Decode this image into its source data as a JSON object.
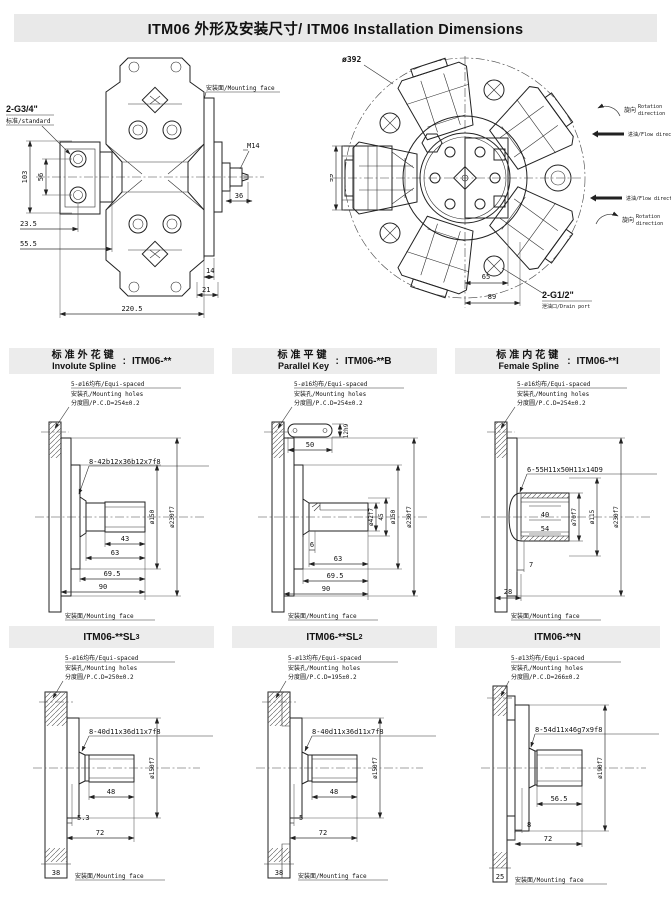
{
  "title": "ITM06 外形及安装尺寸/ ITM06 Installation Dimensions",
  "sep": ":",
  "colors": {
    "line": "#222222",
    "band": "#ececec",
    "paper": "#ffffff"
  },
  "side_view": {
    "ports_label": "2-G3/4\"",
    "ports_sub": "标准/standard",
    "mounting_face": "安装面/Mounting face",
    "shaft_thread": "M14",
    "d36": "36",
    "d103": "103",
    "d56": "56",
    "d23_5": "23.5",
    "d55_5": "55.5",
    "d14": "14",
    "d21": "21",
    "d220_5": "220.5"
  },
  "front_view": {
    "outer_dia": "ø392",
    "d99": "99",
    "d65": "65",
    "d89": "89",
    "drain_label": "2-G1/2\"",
    "drain_sub": "泄油口/Drain port",
    "rotation_cn": "旋向",
    "rotation_en1": "Rotation",
    "rotation_en2": "direction",
    "flow_label": "进油/Flow direction"
  },
  "middle_panels": [
    {
      "title_cn": "标准外花键",
      "title_en": "Involute Spline",
      "model": "ITM06-**",
      "note1": "5-ø16均布/Equi-spaced",
      "note2": "安装孔/Mounting holes",
      "note3": "分度圆/P.C.D=254±0.2",
      "spline": "8-42b12x36b12x7f8",
      "dia1": "ø150",
      "dia2": "ø230f7",
      "dim_a": "43",
      "dim_b": "63",
      "dim_c": "69.5",
      "dim_d": "90",
      "mounting_face": "安装面/Mounting face"
    },
    {
      "title_cn": "标准平键",
      "title_en": "Parallel Key",
      "model": "ITM06-**B",
      "note1": "5-ø16均布/Equi-spaced",
      "note2": "安装孔/Mounting holes",
      "note3": "分度圆/P.C.D=254±0.2",
      "key_len": "50",
      "key_w": "12h9",
      "shaft_dia": "ø42f7",
      "key_h": "45",
      "dia1": "ø150",
      "dia2": "ø230f7",
      "dim_a": "6",
      "dim_b": "63",
      "dim_c": "69.5",
      "dim_d": "90",
      "mounting_face": "安装面/Mounting face"
    },
    {
      "title_cn": "标准内花键",
      "title_en": "Female Spline",
      "model": "ITM06-**I",
      "note1": "5-ø16均布/Equi-spaced",
      "note2": "安装孔/Mounting holes",
      "note3": "分度圆/P.C.D=254±0.2",
      "spline": "6-55H11x50H11x14D9",
      "d40": "40",
      "d54": "54",
      "dia1": "ø70f7",
      "dia2": "ø115",
      "dia3": "ø230f7",
      "dim_a": "7",
      "dim_b": "28",
      "mounting_face": "安装面/Mounting face"
    }
  ],
  "bottom_panels": [
    {
      "model_base": "ITM06-**SL",
      "model_sub": "3",
      "note1": "5-ø16均布/Equi-spaced",
      "note2": "安装孔/Mounting holes",
      "note3": "分度圆/P.C.D=250±0.2",
      "spline": "8-40d11x36d11x7f8",
      "dia1": "ø150f7",
      "dim_a": "48",
      "dim_b": "5.3",
      "dim_c": "72",
      "dim_d": "38",
      "mounting_face": "安装面/Mounting face"
    },
    {
      "model_base": "ITM06-**SL",
      "model_sub": "2",
      "note1": "5-ø13均布/Equi-spaced",
      "note2": "安装孔/Mounting holes",
      "note3": "分度圆/P.C.D=195±0.2",
      "spline": "8-40d11x36d11x7f8",
      "dia1": "ø150f7",
      "dim_a": "48",
      "dim_b": "5",
      "dim_c": "72",
      "dim_d": "38",
      "mounting_face": "安装面/Mounting face"
    },
    {
      "model_base": "ITM06-**N",
      "model_sub": "",
      "note1": "5-ø13均布/Equi-spaced",
      "note2": "安装孔/Mounting holes",
      "note3": "分度圆/P.C.D=266±0.2",
      "spline": "8-54d11x46g7x9f8",
      "dia1": "ø190f7",
      "dim_a": "56.5",
      "dim_b": "8",
      "dim_c": "72",
      "dim_d": "25",
      "mounting_face": "安装面/Mounting face"
    }
  ]
}
